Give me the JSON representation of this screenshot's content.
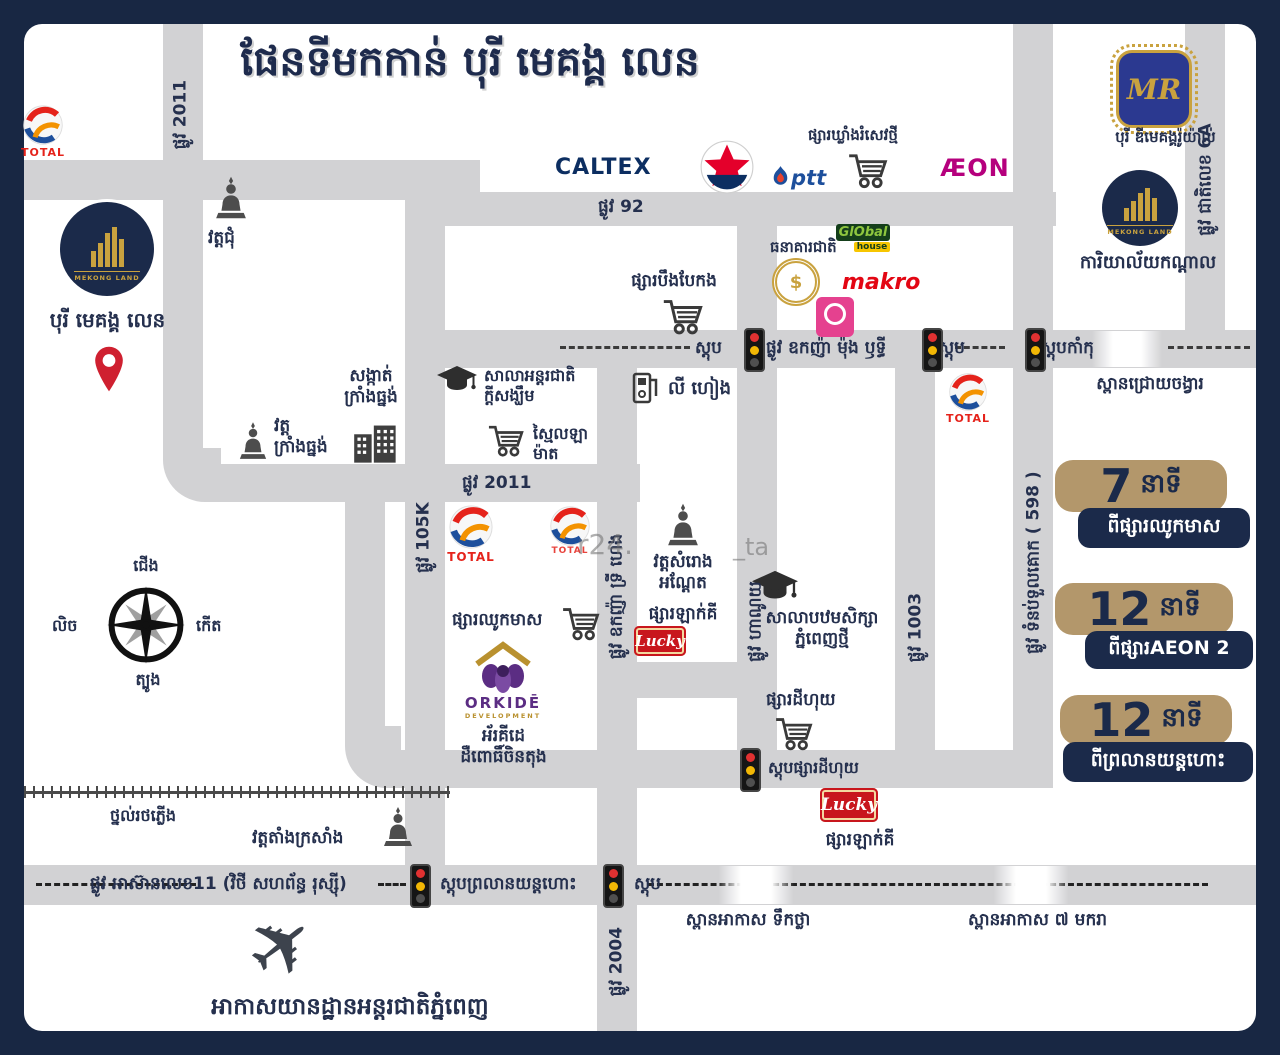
{
  "page": {
    "title": "ផែនទីមកកាន់ បុរី មេគង្គ លេន"
  },
  "watermark": {
    "part1": "r24.",
    "part2": "_ta"
  },
  "compass": {
    "north": "ជើង",
    "south": "ត្បូង",
    "east": "កើត",
    "west": "លិច"
  },
  "icons": {
    "plane": "✈"
  },
  "streets": {
    "s2011": "ផ្លូវ 2011",
    "s92": "ផ្លូវ 92",
    "oknha_mong_rithy": "ផ្លូវ ឧកញ៉ា ម៉ុង ឫទ្ធី",
    "s105k": "ផ្លូវ 105K",
    "oknha_try_heng": "ផ្លូវ ឧកញ៉ា ទ្រី ហេង",
    "hanoi": "ផ្លូវ ហាណូយ",
    "s1003": "ផ្លូវ 1003",
    "tumnup_598": "ផ្លូវ ទំនប់ទួលគោក ( 598 )",
    "national_6a": "ផ្លូវ ជាតិលេខ 6A",
    "s2004": "ផ្លូវ 2004",
    "asean11": "ផ្លូវ អាស៊ានលេខ11 (វិថី សហព័ន្ធ រុស្ស៊ី)",
    "railway": "ថ្នល់រថភ្លើង"
  },
  "stops": {
    "stop": "ស្តុប",
    "kamku": "ស្តុបកាំកុ",
    "dey_huy": "ស្តុបផ្សារដីហុយ",
    "airport": "ស្តុបព្រលានយន្តហោះ"
  },
  "bridges": {
    "chroy_changvar": "ស្ពានជ្រោយចង្វារ",
    "tuek_thla": "ស្ពានអាកាស ទឹកថ្លា",
    "makara7": "ស្ពានអាកាស ៧ មករា"
  },
  "landmarks": {
    "wat_chum": "វត្តជុំ",
    "borey_mekong_len": "បុរី មេគង្គ លេន",
    "sangkat_line1": "សង្កាត់",
    "sangkat_line2": "ក្រាំងធ្នង់",
    "wat_krang_line1": "វត្ត",
    "wat_krang_line2": "ក្រាំងធ្នង់",
    "hope_line1": "សាលាអន្តរជាតិ",
    "hope_line2": "ក្តីសង្ឃឹម",
    "mart_line1": "ស្មៃលឡា",
    "mart_line2": "ម៉ាត",
    "boeng_baek_kang": "ផ្សារបឹងបែកង",
    "khlang_romsev": "ផ្សារឃ្លាំងរំសេវថ្មី",
    "ly_heang": "លី ហៀង",
    "national_bank": "ធនាគារជាតិ",
    "chhouk_meas": "ផ្សារឈូកមាស",
    "orkide_line1": "អ័រគីដេ",
    "orkide_line2": "ដឺពោធិ៍ចិនតុង",
    "samrong_line1": "វត្តសំរោង",
    "samrong_line2": "អណ្ដែត",
    "lucky_market": "ផ្សារឡាក់គី",
    "pp_school_line1": "សាលាបឋមសិក្សា",
    "pp_school_line2": "ភ្នំពេញថ្មី",
    "dey_huy_market": "ផ្សារដីហុយ",
    "wat_tang_krasang": "វត្តតាំងក្រសាំង",
    "airport_name": "អាកាសយានដ្ឋានអន្តរជាតិភ្នំពេញ",
    "dmekong_royal": "បុរី ឌីមេគង្គរ៉ូយ៉ាល់",
    "central_office": "ការិយាល័យកណ្តាល"
  },
  "badges": [
    {
      "minutes": "7",
      "unit": "នាទី",
      "from": "ពីផ្សារឈូកមាស"
    },
    {
      "minutes": "12",
      "unit": "នាទី",
      "from": "ពីផ្សារAEON 2"
    },
    {
      "minutes": "12",
      "unit": "នាទី",
      "from": "ពីព្រលានយន្តហោះ"
    }
  ],
  "brands": {
    "total": "TOTAL",
    "caltex": "CALTEX",
    "ptt": "ptt",
    "aeon": "ÆON",
    "global": "GlObal",
    "global_sub": "house",
    "makro": "makro",
    "lucky": "Lucky",
    "orkide": "ORKIDĒ",
    "orkide_sub": "DEVELOPMENT",
    "mekong_land": "MEKONG LAND",
    "mr": "MR",
    "bank_seal": "$"
  },
  "colors": {
    "navy": "#1b2a4a",
    "road_gray": "#d2d2d4",
    "badge_tan": "#b3976b",
    "pin_red": "#cf2030",
    "lucky_red": "#c8161d",
    "aeon_magenta": "#b5007d",
    "makro_red": "#e30613",
    "global_green": "#153f1b",
    "gold": "#c9a23f",
    "orkide_purple": "#5b2d83",
    "total_red": "#e5231b",
    "ptt_blue": "#1d4f9c"
  }
}
